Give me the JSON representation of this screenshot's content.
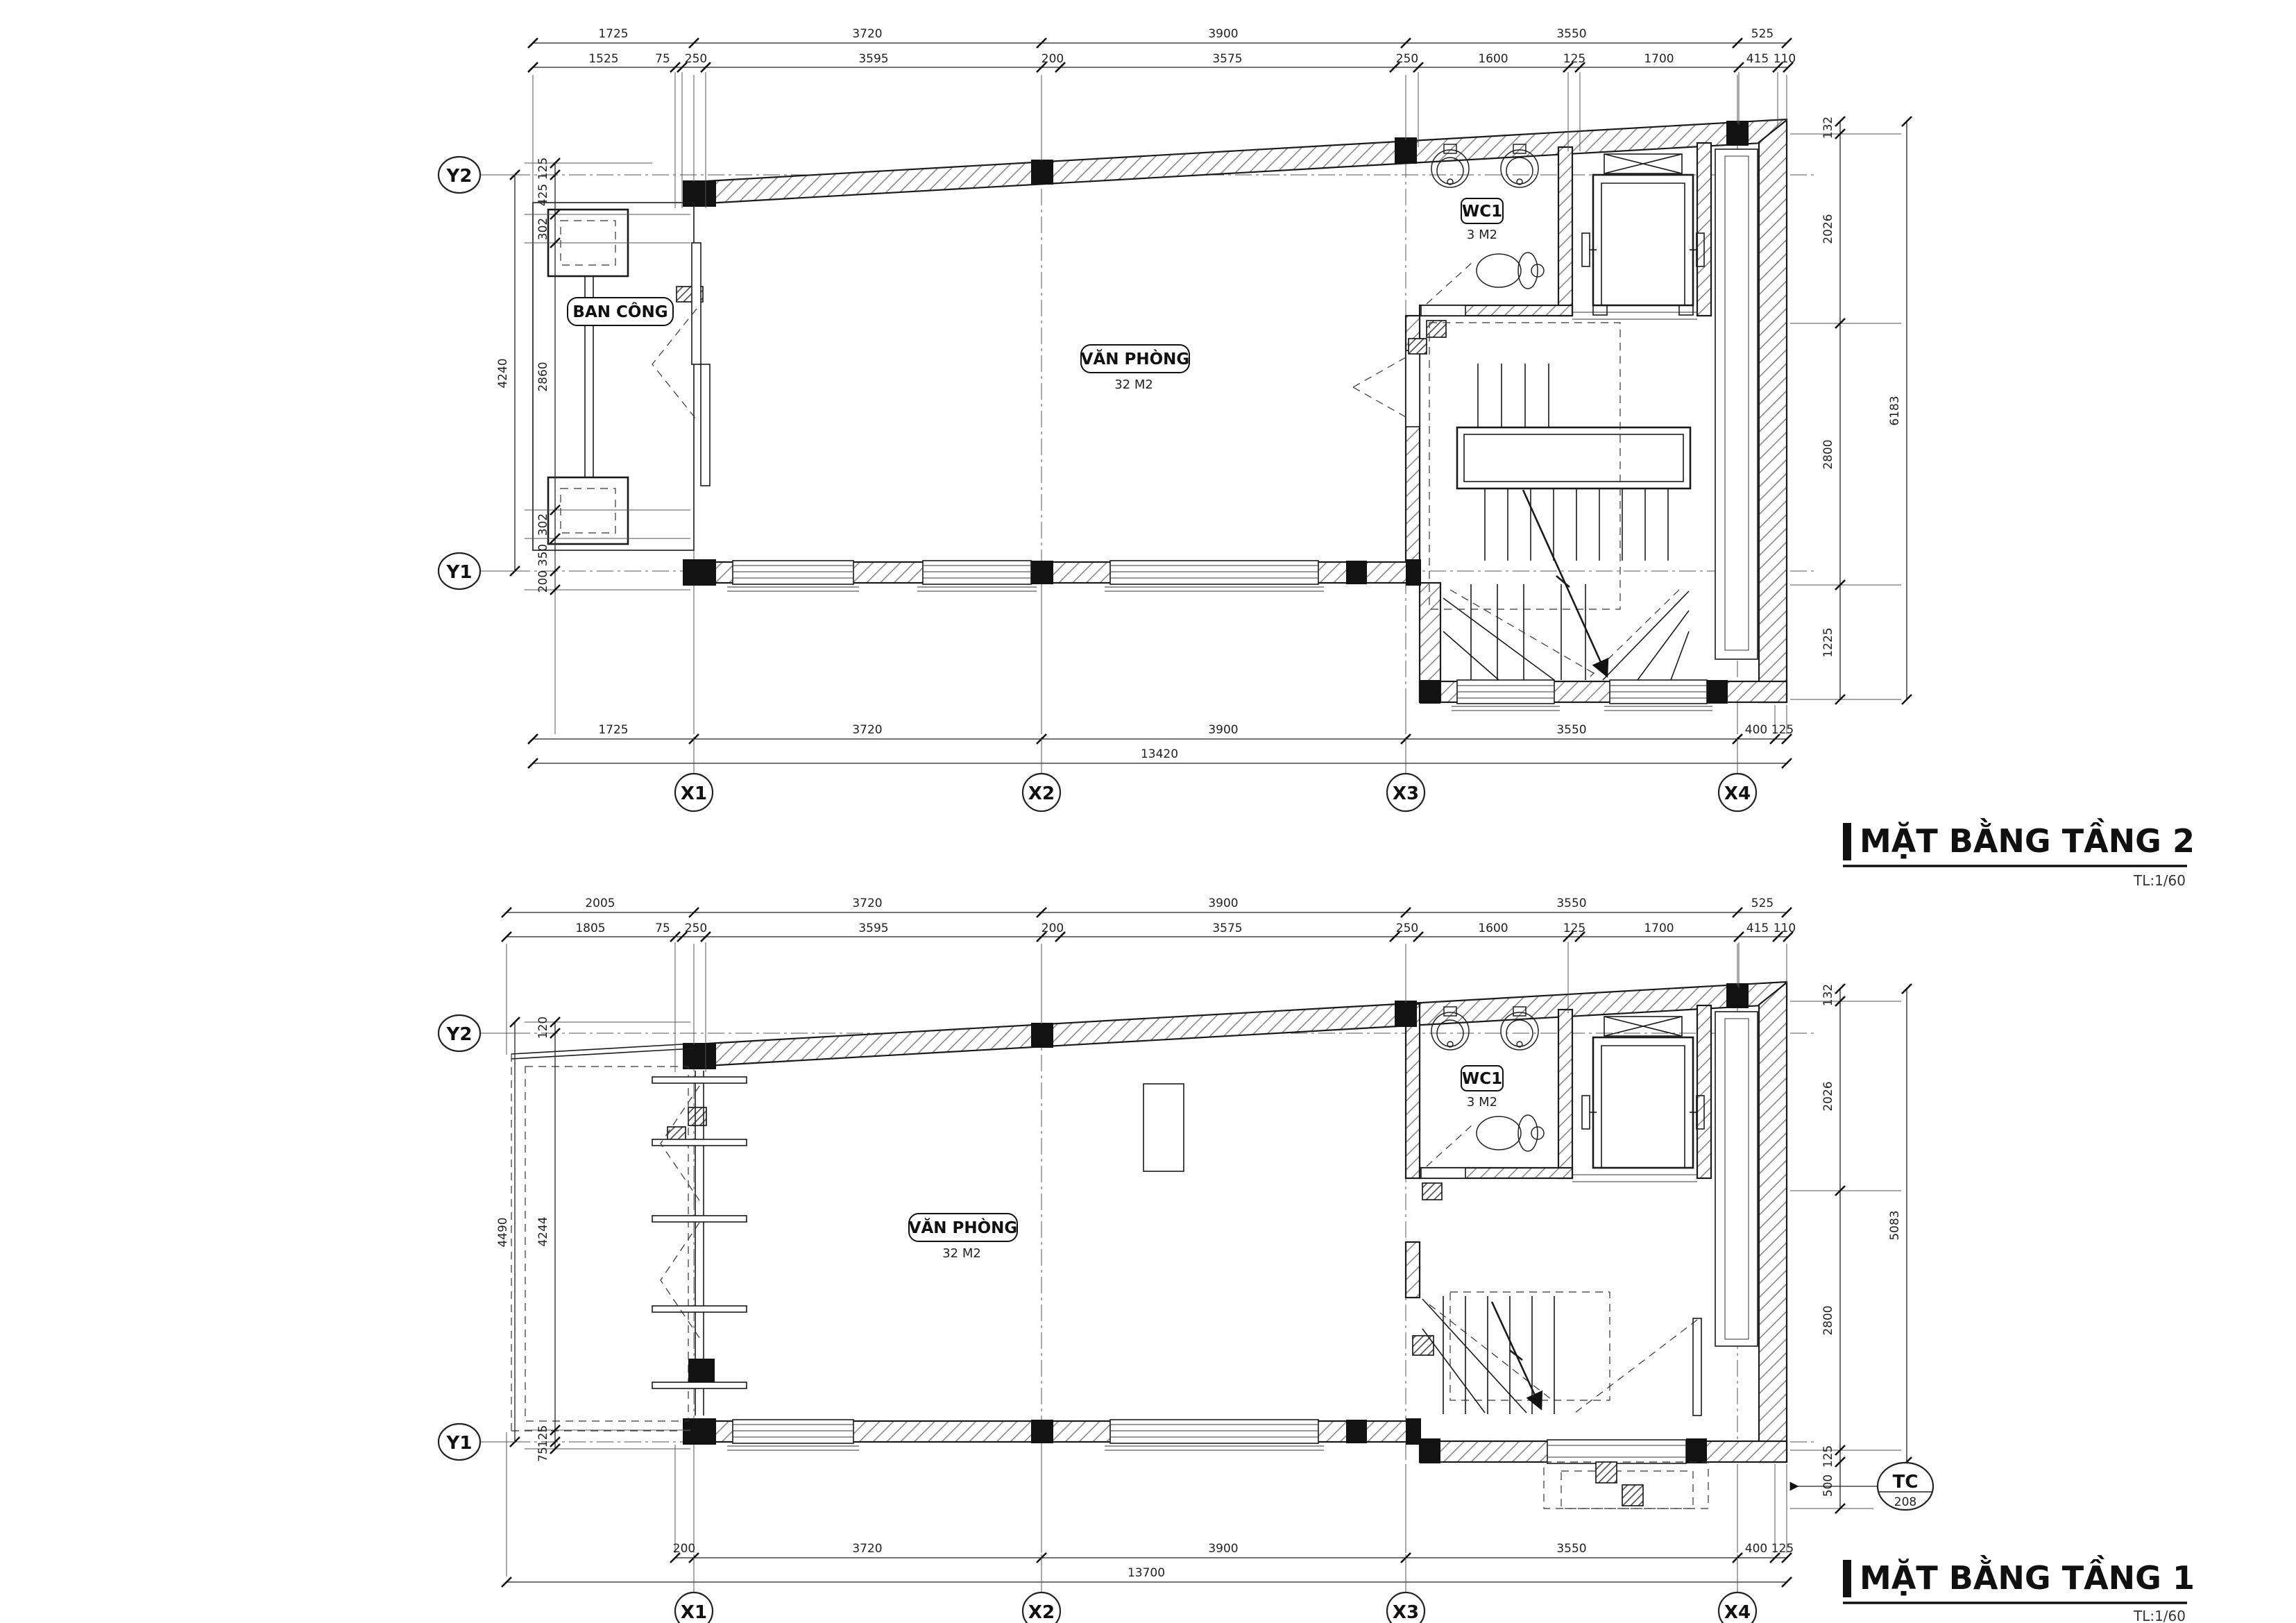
{
  "colors": {
    "ink": "#1b1b1b",
    "paper": "#ffffff"
  },
  "titles": {
    "plan2": {
      "label": "MẶT BẰNG TẦNG 2",
      "scale": "TL:1/60"
    },
    "plan1": {
      "label": "MẶT BẰNG TẦNG 1",
      "scale": "TL:1/60"
    }
  },
  "grid": {
    "x": [
      "X1",
      "X2",
      "X3",
      "X4"
    ],
    "y": [
      "Y2",
      "Y1"
    ]
  },
  "plan2": {
    "rooms": {
      "office": {
        "name": "VĂN PHÒNG",
        "area": "32 M2"
      },
      "wc": {
        "name": "WC1",
        "area": "3 M2"
      },
      "balcony": {
        "name": "BAN CÔNG"
      }
    },
    "dims": {
      "top_row1": [
        "1725",
        "3720",
        "3900",
        "3550",
        "525"
      ],
      "top_row2": [
        "1525",
        "75",
        "250",
        "3595",
        "200",
        "3575",
        "250",
        "1600",
        "125",
        "1700",
        "415",
        "110"
      ],
      "bottom_row1": [
        "1725",
        "3720",
        "3900",
        "3550",
        "400",
        "125"
      ],
      "bottom_total": "13420",
      "left_outer": "4240",
      "left_chain": [
        "125",
        "425",
        "302",
        "2860",
        "302",
        "350",
        "200"
      ],
      "right_chain": [
        "132",
        "2026",
        "2800",
        "1225"
      ],
      "right_outer": "6183"
    }
  },
  "plan1": {
    "rooms": {
      "office": {
        "name": "VĂN PHÒNG",
        "area": "32 M2"
      },
      "wc": {
        "name": "WC1",
        "area": "3 M2"
      }
    },
    "symbols": {
      "tc": {
        "top": "TC",
        "bottom": "208"
      }
    },
    "dims": {
      "top_row1": [
        "2005",
        "3720",
        "3900",
        "3550",
        "525"
      ],
      "top_row2": [
        "1805",
        "75",
        "250",
        "3595",
        "200",
        "3575",
        "250",
        "1600",
        "125",
        "1700",
        "415",
        "110"
      ],
      "bottom_row1": [
        "200",
        "3720",
        "3900",
        "3550",
        "400",
        "125"
      ],
      "bottom_total": "13700",
      "left_outer": "4490",
      "left_chain": [
        "120",
        "4244",
        "125",
        "75"
      ],
      "right_chain": [
        "132",
        "2026",
        "2800",
        "125",
        "500"
      ],
      "right_outer": "5083"
    }
  }
}
